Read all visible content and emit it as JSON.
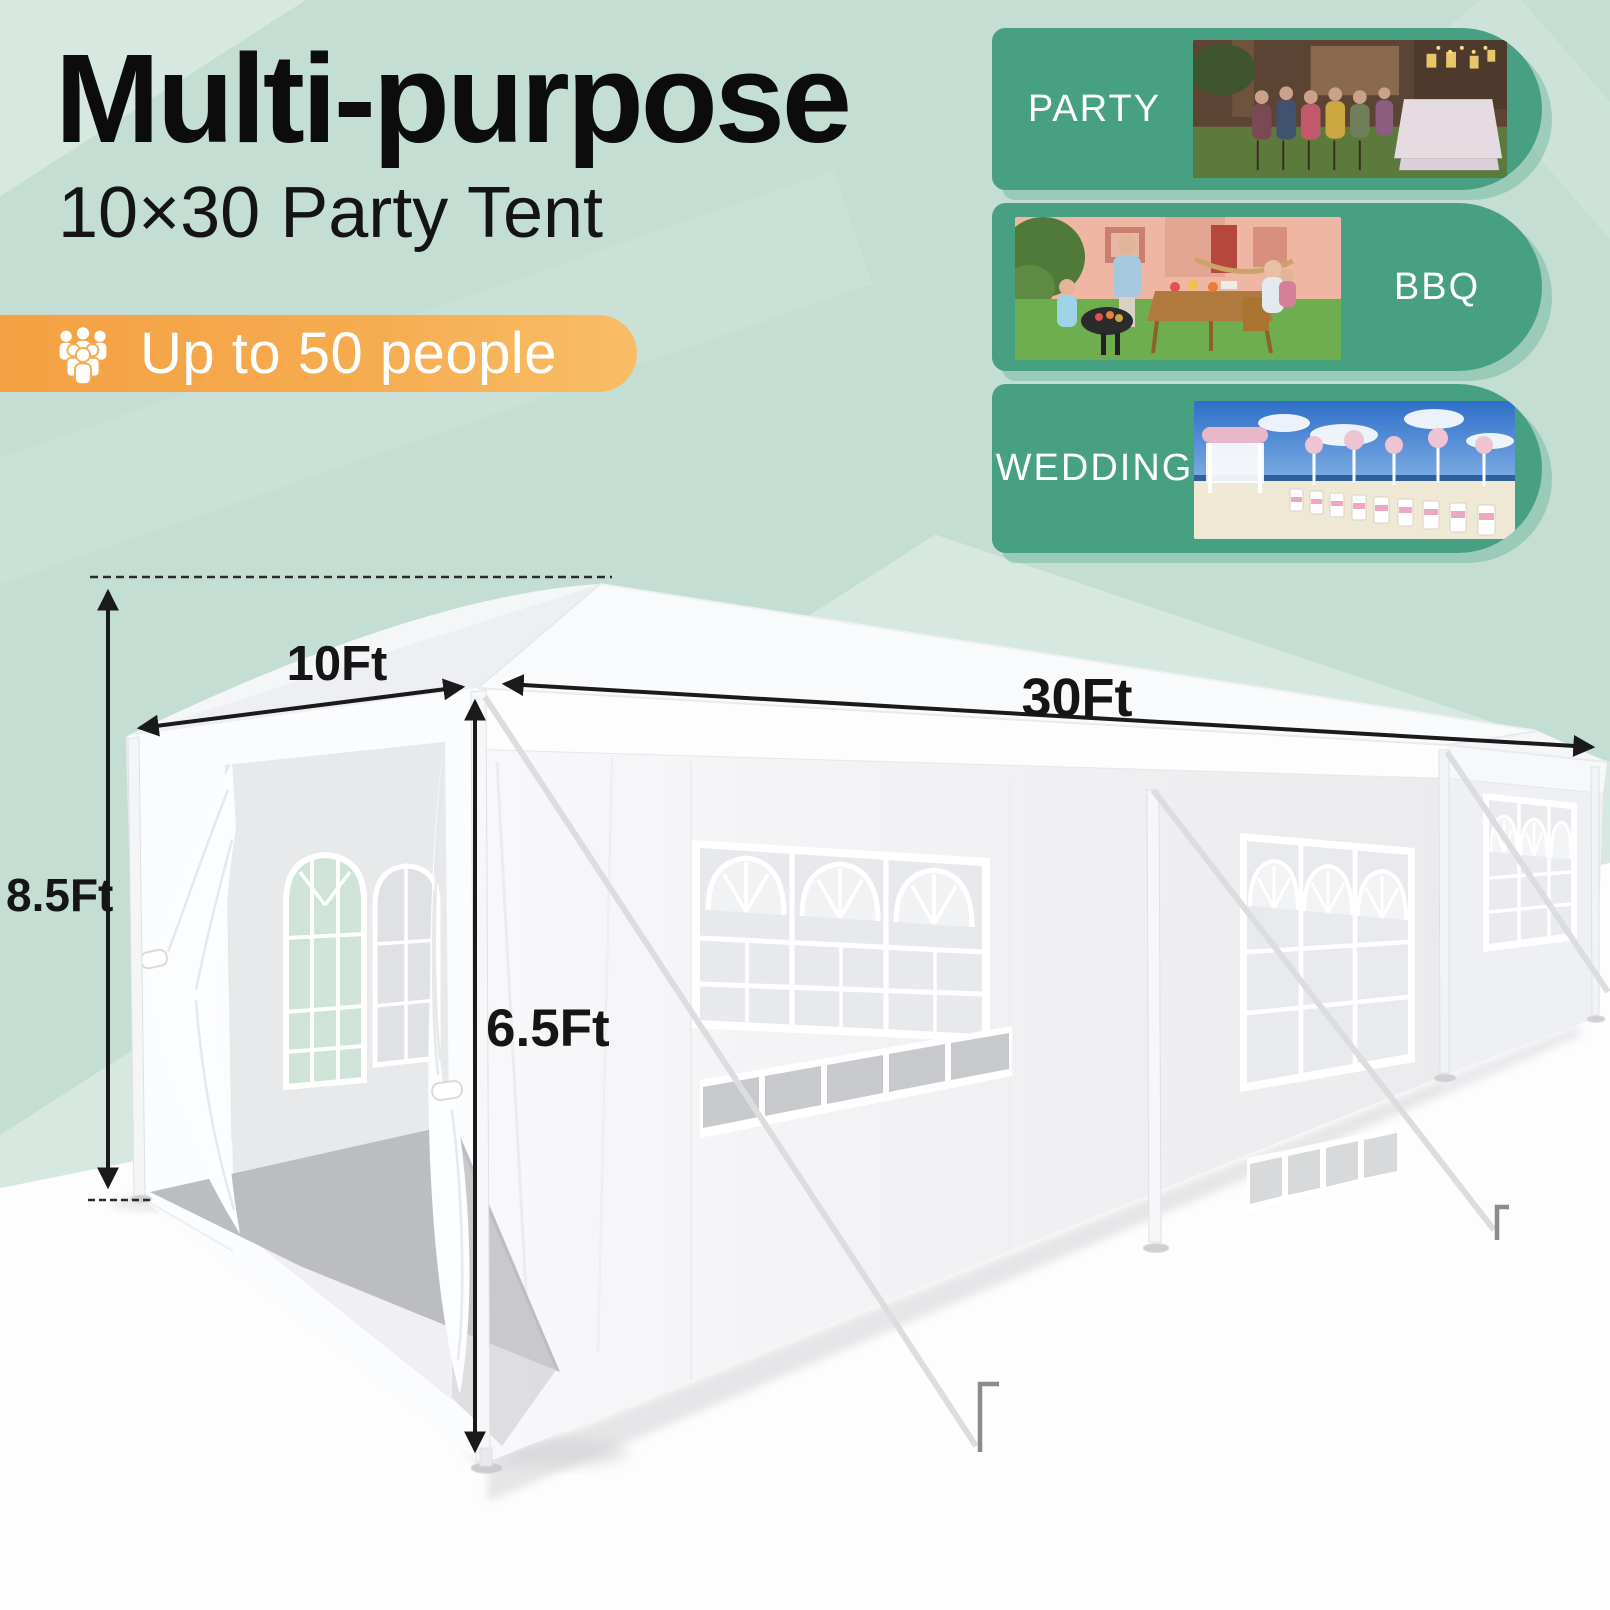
{
  "title": {
    "heading": "Multi-purpose",
    "subheading": "10×30 Party Tent"
  },
  "badge": {
    "label": "Up to 50 people",
    "icon": "people-group-icon",
    "bg_start": "#F3A143",
    "bg_end": "#F9BD67",
    "text_color": "#FFFFFF"
  },
  "use_cases": [
    {
      "label": "PARTY",
      "image": "backyard-evening-party-photo",
      "layout": "label-left"
    },
    {
      "label": "BBQ",
      "image": "family-garden-bbq-photo",
      "layout": "label-right"
    },
    {
      "label": "WEDDING",
      "image": "beach-wedding-ceremony-photo",
      "layout": "label-left"
    }
  ],
  "colors": {
    "card_green": "#47A082",
    "background_mint": "#C4DED3",
    "ground_white": "#FDFDFE",
    "dimension_text": "#151515"
  },
  "diagram": {
    "subject": "white party tent with windows and open door curtains",
    "width_label": "10Ft",
    "length_label": "30Ft",
    "peak_height_label": "8.5Ft",
    "side_height_label": "6.5Ft"
  }
}
